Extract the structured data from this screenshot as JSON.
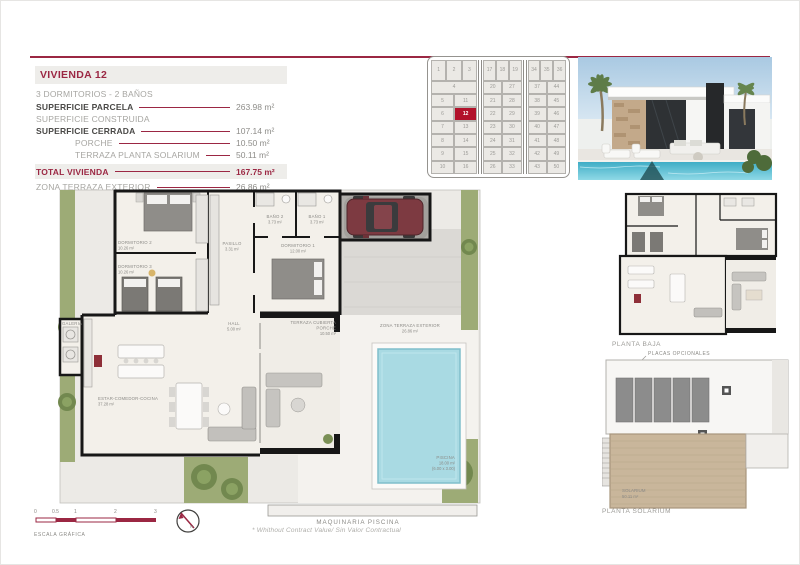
{
  "colors": {
    "accent": "#9b2743",
    "plot_highlight": "#b2122b",
    "pool": "#a9dae3",
    "garden": "#9dab76",
    "wood_deck": "#c9b69b"
  },
  "spec": {
    "title": "VIVIENDA 12",
    "subtitle": "3 DORMITORIOS - 2 BAÑOS",
    "rows": [
      {
        "label": "SUPERFICIE PARCELA",
        "value": "263.98 m²"
      },
      {
        "label": "SUPERFICIE CONSTRUIDA",
        "value": ""
      },
      {
        "label": "SUPERFICIE CERRADA",
        "value": "107.14 m²"
      },
      {
        "label": "PORCHE",
        "value": "10.50 m²"
      },
      {
        "label": "TERRAZA PLANTA SOLARIUM",
        "value": "50.11 m²"
      },
      {
        "label": "TOTAL VIVIENDA",
        "value": "167.75 m²"
      },
      {
        "label": "ZONA TERRAZA EXTERIOR",
        "value": "26.86 m²"
      }
    ]
  },
  "siteplan": {
    "highlight": "12",
    "blocks": [
      [
        [
          "1",
          "2",
          "3"
        ],
        [
          "4"
        ],
        [
          "5",
          "11"
        ],
        [
          "6",
          "12"
        ],
        [
          "7",
          "13"
        ],
        [
          "8",
          "14"
        ],
        [
          "9",
          "15"
        ],
        [
          "10",
          "16"
        ]
      ],
      [
        [
          "17",
          "18",
          "19"
        ],
        [
          "20",
          "27"
        ],
        [
          "21",
          "28"
        ],
        [
          "22",
          "29"
        ],
        [
          "23",
          "30"
        ],
        [
          "24",
          "31"
        ],
        [
          "25",
          "32"
        ],
        [
          "26",
          "33"
        ]
      ],
      [
        [
          "34",
          "35",
          "36"
        ],
        [
          "37",
          "44"
        ],
        [
          "38",
          "45"
        ],
        [
          "39",
          "46"
        ],
        [
          "40",
          "47"
        ],
        [
          "41",
          "48"
        ],
        [
          "42",
          "49"
        ],
        [
          "43",
          "50"
        ]
      ]
    ]
  },
  "plan": {
    "rooms": {
      "dorm2": {
        "name": "DORMITORIO 2",
        "area": "10.26 m²"
      },
      "dorm3": {
        "name": "DORMITORIO 3",
        "area": "10.26 m²"
      },
      "pasillo": {
        "name": "PASILLO",
        "area": "3.31 m²"
      },
      "bano2": {
        "name": "BAÑO 2",
        "area": "3.73 m²"
      },
      "bano1": {
        "name": "BAÑO 1",
        "area": "3.73 m²"
      },
      "dorm1": {
        "name": "DORMITORIO 1",
        "area": "12.00 m²"
      },
      "hall": {
        "name": "HALL",
        "area": "5.00 m²"
      },
      "estar": {
        "name": "ESTAR-COMEDOR-COCINA",
        "area": "37.28 m²"
      },
      "terraza_cubierta": {
        "name": "TERRAZA CUBIERTA",
        "name2": "PORCHE",
        "area": "10.50 m²"
      },
      "zona_terraza": {
        "name": "ZONA TERRAZA EXTERIOR",
        "area": "26.86 m²"
      },
      "piscina": {
        "name": "PISCINA",
        "area": "18.00 m²",
        "dims": "(6.00 x 3.00)"
      },
      "galeria": {
        "name": "GALERIA"
      },
      "maquinaria": {
        "name": "MAQUINARIA PISCINA"
      }
    }
  },
  "solarium_plan": {
    "placas": "PLACAS OPCIONALES",
    "solarium_label": "SOLARIUM",
    "solarium_area": "50.11 m²"
  },
  "captions": {
    "planta_baja": "PLANTA BAJA",
    "planta_solarium": "PLANTA SOLARIUM"
  },
  "scale": {
    "ticks": [
      "0",
      "0.5",
      "1",
      "2",
      "3"
    ],
    "label": "ESCALA GRÁFICA",
    "north": "N"
  },
  "footnote": "* Whithout Contract Value/ Sin Valor Contractual"
}
